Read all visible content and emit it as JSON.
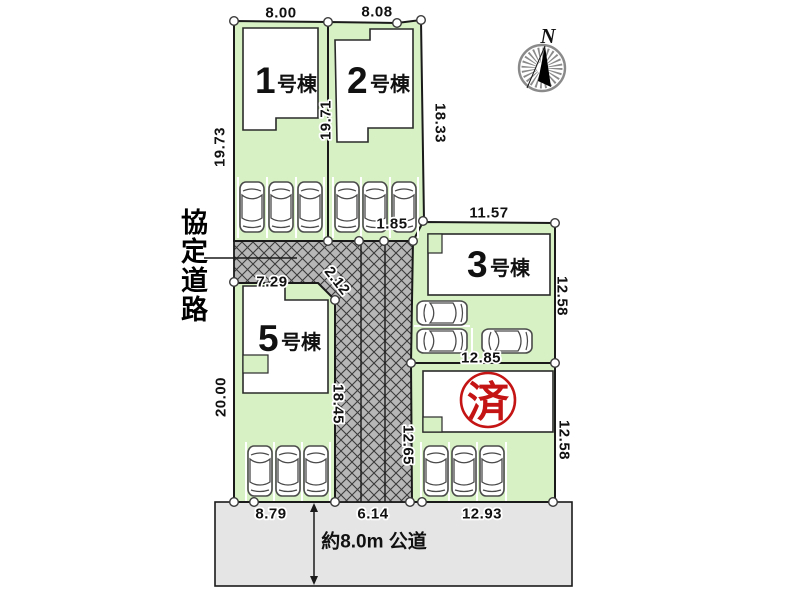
{
  "compass": {
    "north": "N"
  },
  "lots": {
    "lot1": {
      "num": "1",
      "suffix": "号棟"
    },
    "lot2": {
      "num": "2",
      "suffix": "号棟"
    },
    "lot3": {
      "num": "3",
      "suffix": "号棟"
    },
    "lot5": {
      "num": "5",
      "suffix": "号棟"
    },
    "lot4_stamp": "済"
  },
  "roads": {
    "agreement": "協定道路",
    "public": "約8.0m 公道"
  },
  "dimensions": {
    "d800": "8.00",
    "d808": "8.08",
    "d1973": "19.73",
    "d1971": "19.71",
    "d1833": "18.33",
    "d185": "1.85",
    "d1157": "11.57",
    "d1258a": "12.58",
    "d729": "7.29",
    "d212": "2.12",
    "d1845": "18.45",
    "d1285": "12.85",
    "d1265": "12.65",
    "d1258b": "12.58",
    "d2000": "20.00",
    "d879": "8.79",
    "d614": "6.14",
    "d1293": "12.93"
  },
  "colors": {
    "lot_green": "#d7f1c4",
    "hatch_gray": "#b7b7b7",
    "public_road_gray": "#e5e5e5",
    "stamp_red": "#c41414",
    "line_black": "#1a1a1a"
  }
}
